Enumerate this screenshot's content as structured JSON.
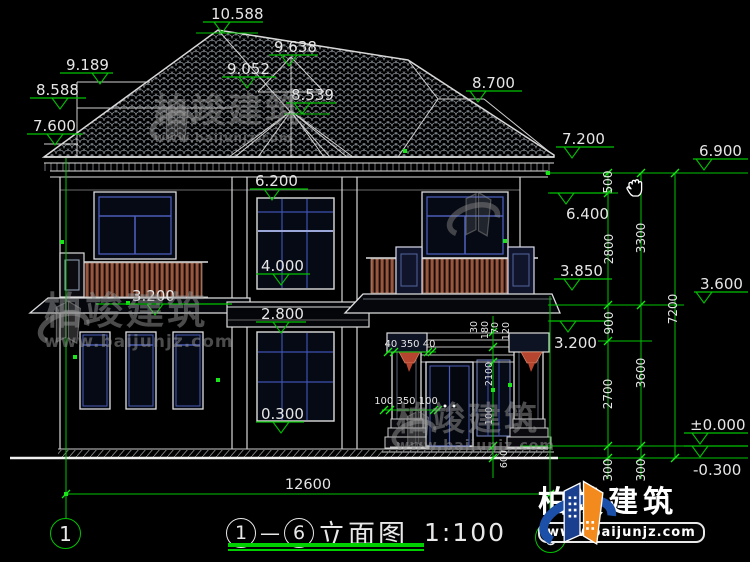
{
  "title_block": {
    "bubble_left": "1",
    "separator": "—",
    "bubble_right": "6",
    "name": "立面图",
    "scale": "1:100"
  },
  "watermark": {
    "brand": "柏竣建筑",
    "url": "www.baijunjz.com"
  },
  "brand_logo": {
    "brand": "柏竣建筑",
    "url": "www.baijunjz.com"
  },
  "colors": {
    "background": "#000000",
    "dimension_green": "#00c400",
    "snap_green": "#19e619",
    "line_white": "#e6e6e6",
    "window_blue": "#4a5cb8",
    "railing_brown": "#9a5740",
    "corbel_red": "#b5452f",
    "logo_blue": "#1b4fa8",
    "logo_orange": "#f28a1d"
  },
  "dimensions": {
    "elevation_markers": [
      {
        "label": "10.588",
        "tx": 211,
        "ty": 19,
        "x1": 203,
        "x2": 263,
        "ly": 22,
        "ax": 222,
        "base": [
          196,
          258,
          33
        ]
      },
      {
        "label": "9.638",
        "tx": 274,
        "ty": 52,
        "x1": 269,
        "x2": 318,
        "ly": 55,
        "ax": 289
      },
      {
        "label": "9.052",
        "tx": 227,
        "ty": 74,
        "x1": 222,
        "x2": 276,
        "ly": 77,
        "ax": 247
      },
      {
        "label": "8.539",
        "tx": 291,
        "ty": 100,
        "x1": 286,
        "x2": 336,
        "ly": 103,
        "ax": 302,
        "base": [
          284,
          330,
          114
        ]
      },
      {
        "label": "9.189",
        "tx": 66,
        "ty": 70,
        "x1": 60,
        "x2": 113,
        "ly": 73,
        "ax": 100
      },
      {
        "label": "8.588",
        "tx": 36,
        "ty": 95,
        "x1": 30,
        "x2": 86,
        "ly": 98,
        "ax": 60
      },
      {
        "label": "7.600",
        "tx": 33,
        "ty": 131,
        "x1": 27,
        "x2": 83,
        "ly": 134,
        "ax": 55
      },
      {
        "label": "8.700",
        "tx": 472,
        "ty": 88,
        "x1": 466,
        "x2": 522,
        "ly": 91,
        "ax": 478
      },
      {
        "label": "7.200",
        "tx": 562,
        "ty": 144,
        "x1": 556,
        "x2": 614,
        "ly": 147,
        "ax": 572
      },
      {
        "label": "6.900",
        "tx": 699,
        "ty": 156,
        "x1": 693,
        "x2": 748,
        "ly": 159,
        "ax": 704
      },
      {
        "label": "6.400",
        "tx": 566,
        "ty": 219,
        "x1": 550,
        "x2": 612,
        "ly": 193,
        "ax": 566
      },
      {
        "label": "3.850",
        "tx": 560,
        "ty": 276,
        "x1": 554,
        "x2": 612,
        "ly": 279,
        "ax": 572
      },
      {
        "label": "3.600",
        "tx": 700,
        "ty": 289,
        "x1": 694,
        "x2": 748,
        "ly": 292,
        "ax": 704
      },
      {
        "label": "3.200",
        "tx": 554,
        "ty": 348,
        "x1": 550,
        "x2": 610,
        "ly": 321,
        "ax": 568
      },
      {
        "label": "±0.000",
        "tx": 690,
        "ty": 430,
        "x1": 684,
        "x2": 748,
        "ly": 433,
        "ax": 700
      },
      {
        "label": "-0.300",
        "tx": 693,
        "ty": 475,
        "x1": 684,
        "x2": 748,
        "ly": 446,
        "ax": 700
      },
      {
        "label": "6.200",
        "tx": 255,
        "ty": 186,
        "x1": 250,
        "x2": 308,
        "ly": 189,
        "ax": 272
      },
      {
        "label": "4.000",
        "tx": 261,
        "ty": 271,
        "x1": 256,
        "x2": 310,
        "ly": 274,
        "ax": 281
      },
      {
        "label": "2.800",
        "tx": 261,
        "ty": 319,
        "x1": 256,
        "x2": 306,
        "ly": 322,
        "ax": 281
      },
      {
        "label": "0.300",
        "tx": 261,
        "ty": 419,
        "x1": 256,
        "x2": 304,
        "ly": 422,
        "ax": 281
      },
      {
        "label": "3.200",
        "tx": 132,
        "ty": 301,
        "x1": 96,
        "x2": 232,
        "ly": 304,
        "ax": 155
      }
    ],
    "chain_labels": [
      {
        "t": "500",
        "x": 612,
        "y": 182
      },
      {
        "t": "2800",
        "x": 613,
        "y": 249
      },
      {
        "t": "900",
        "x": 613,
        "y": 323
      },
      {
        "t": "2700",
        "x": 612,
        "y": 394
      },
      {
        "t": "300",
        "x": 612,
        "y": 470
      },
      {
        "t": "3300",
        "x": 645,
        "y": 238
      },
      {
        "t": "3600",
        "x": 645,
        "y": 373
      },
      {
        "t": "300",
        "x": 645,
        "y": 470
      },
      {
        "t": "7200",
        "x": 677,
        "y": 309
      }
    ],
    "small_labels": [
      {
        "t": "30",
        "x": 477,
        "y": 327
      },
      {
        "t": "180",
        "x": 488,
        "y": 330
      },
      {
        "t": "70",
        "x": 498,
        "y": 328
      },
      {
        "t": "120",
        "x": 509,
        "y": 331
      },
      {
        "t": "2100",
        "x": 492,
        "y": 374
      },
      {
        "t": "100",
        "x": 492,
        "y": 416
      },
      {
        "t": "600",
        "x": 507,
        "y": 459
      }
    ],
    "linear_labels": [
      {
        "t": "12600",
        "x": 308,
        "y": 489,
        "s": 14.5
      },
      {
        "t": "40 350 40",
        "x": 410,
        "y": 347,
        "s": 10
      },
      {
        "t": "100 350 100",
        "x": 406,
        "y": 404,
        "s": 10
      }
    ]
  }
}
